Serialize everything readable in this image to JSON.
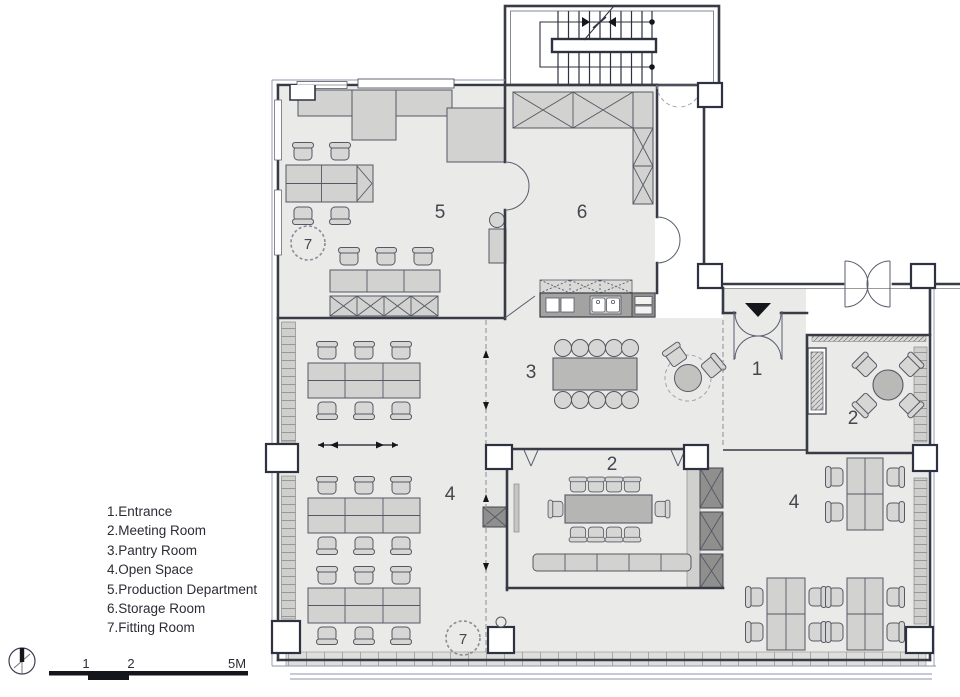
{
  "palette": {
    "wall": "#383b46",
    "furniture": "#d6d6d4",
    "dark_cabinet": "#8f8f8d",
    "floor": "#eaeae8",
    "text": "#2b2c35"
  },
  "legend": {
    "items": [
      {
        "label": "1.Entrance"
      },
      {
        "label": "2.Meeting Room"
      },
      {
        "label": "3.Pantry Room"
      },
      {
        "label": "4.Open Space"
      },
      {
        "label": "5.Production Department"
      },
      {
        "label": "6.Storage Room"
      },
      {
        "label": "7.Fitting Room"
      }
    ]
  },
  "plan": {
    "room_labels": [
      {
        "label": "5"
      },
      {
        "label": "6"
      },
      {
        "label": "3"
      },
      {
        "label": "1"
      },
      {
        "label": "2"
      },
      {
        "label": "2"
      },
      {
        "label": "4"
      },
      {
        "label": "4"
      }
    ],
    "fitting_markers": [
      {
        "label": "7"
      },
      {
        "label": "7"
      }
    ]
  },
  "scale_bar": {
    "ticks": [
      "1",
      "2",
      "5M"
    ]
  }
}
